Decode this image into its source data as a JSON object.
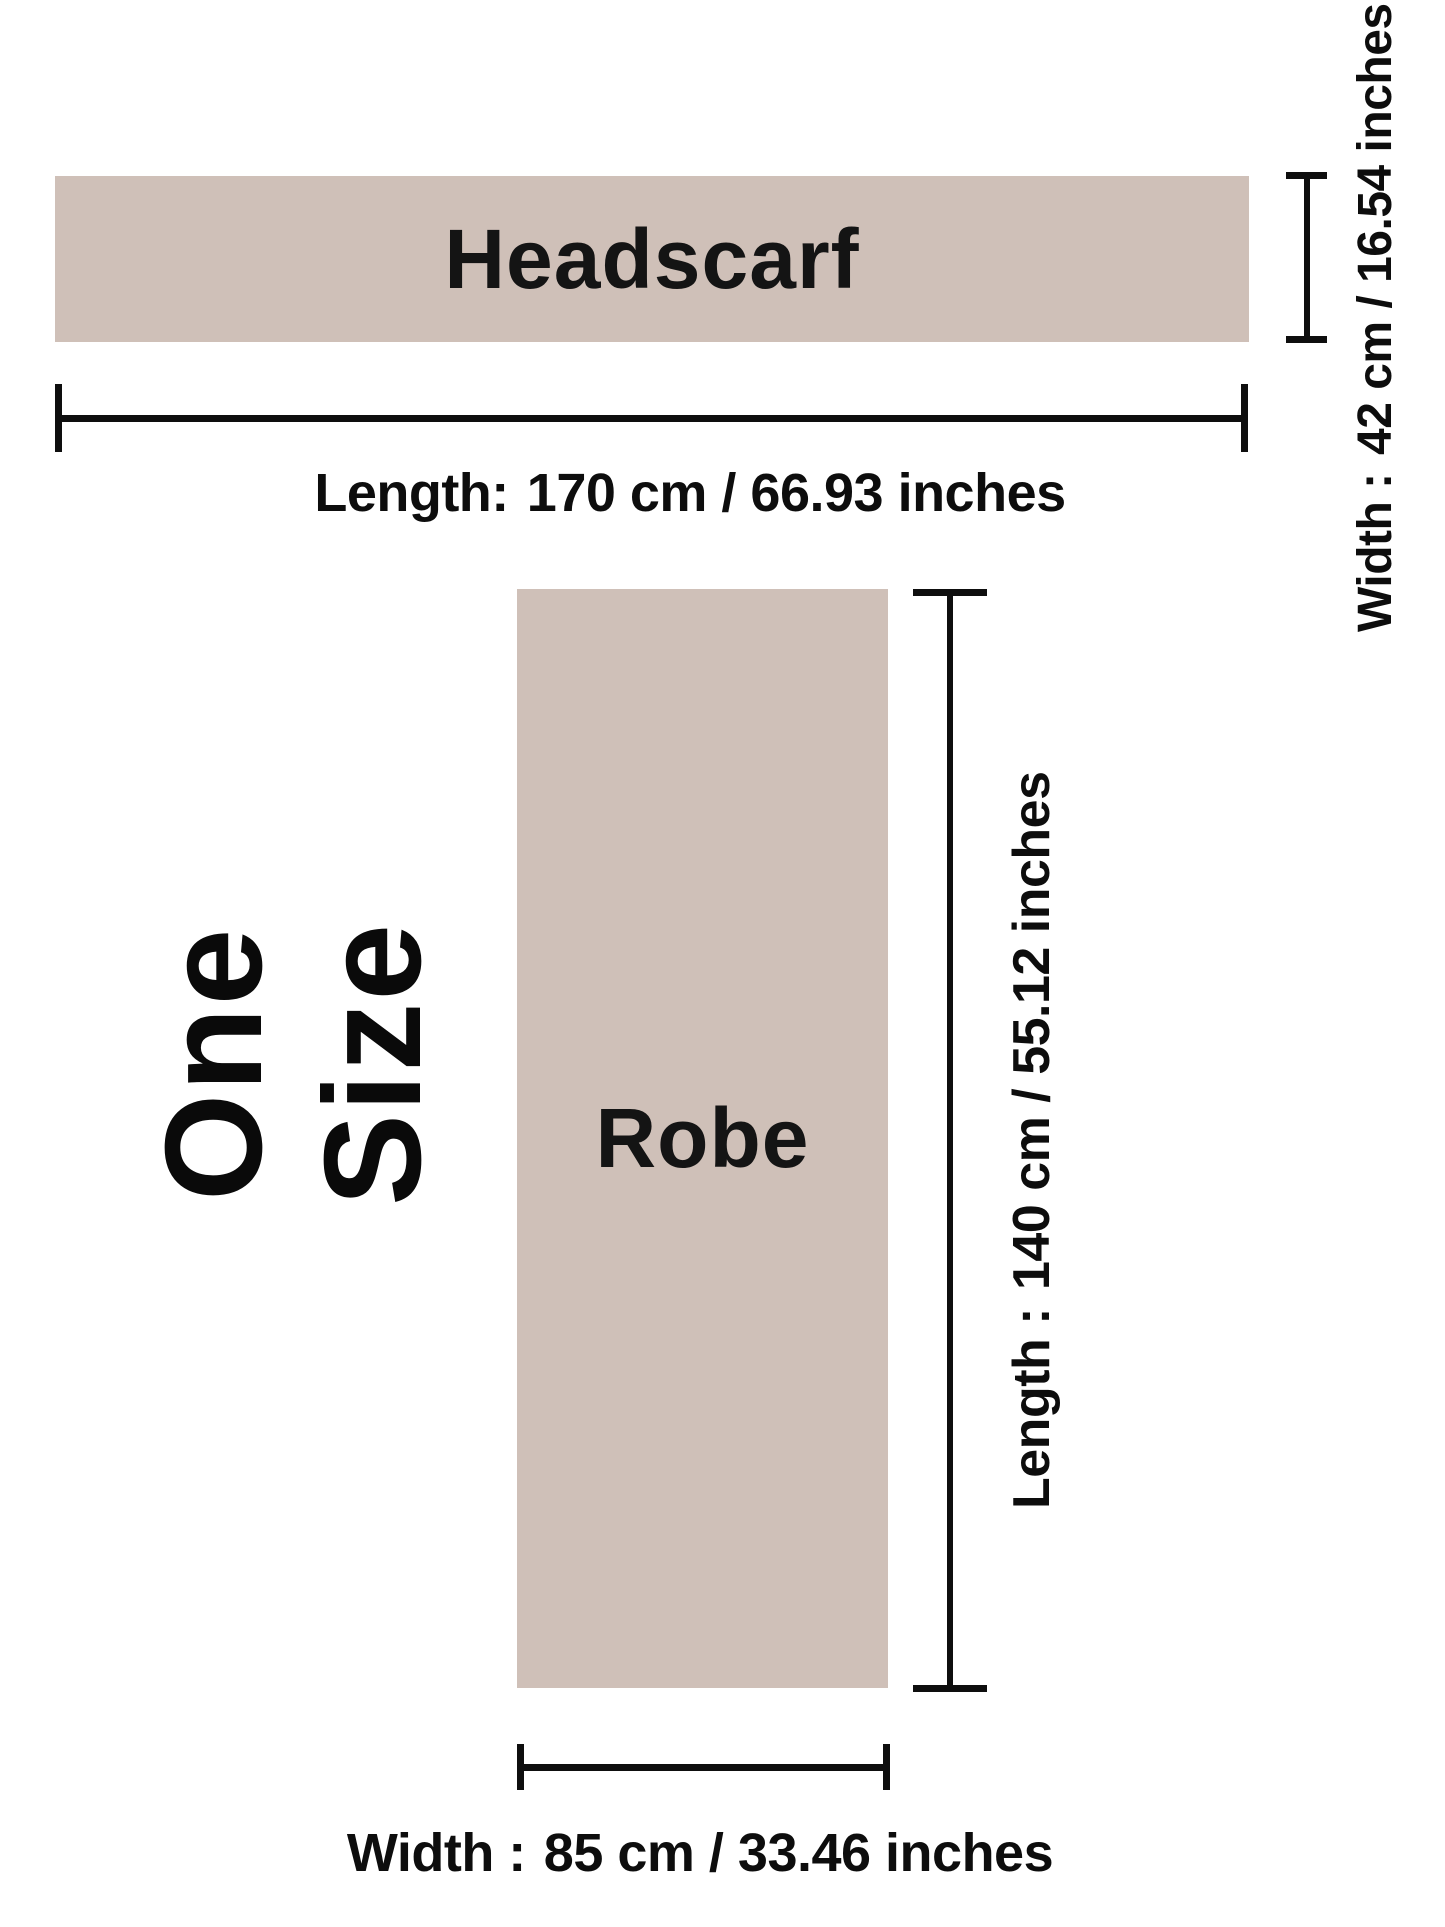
{
  "theme": {
    "background": "#ffffff",
    "swatch": "#cfc0b8",
    "line": "#0e0e0e",
    "text": "#111111"
  },
  "size_label": "One Size",
  "headscarf": {
    "name": "Headscarf",
    "length": {
      "label": "Length:",
      "value": "170 cm / 66.93 inches"
    },
    "width": {
      "label": "Width :",
      "value": "42 cm / 16.54 inches"
    }
  },
  "robe": {
    "name": "Robe",
    "length": {
      "label": "Length :",
      "value": "140 cm / 55.12 inches"
    },
    "width": {
      "label": "Width :",
      "value": "85 cm / 33.46 inches"
    }
  }
}
